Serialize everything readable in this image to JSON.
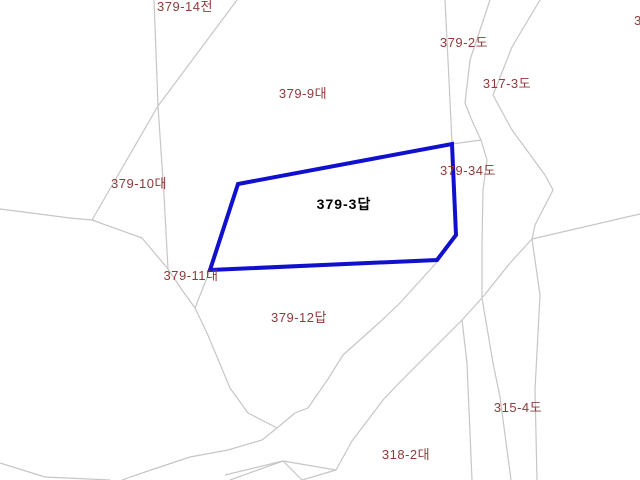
{
  "map": {
    "kind": "cadastral-parcel-map",
    "background": "#ffffff",
    "colors": {
      "boundary": "#c6c6c6",
      "highlight": "#1010cd",
      "label": "#8e3a3a",
      "highlight_label": "#000000"
    },
    "parcels": [
      {
        "label": "379-14전"
      },
      {
        "label": "379-2도"
      },
      {
        "label": "317-3도"
      },
      {
        "label": "379-9대"
      },
      {
        "label": "379-10대"
      },
      {
        "label": "379-34도"
      },
      {
        "label": "379-11대"
      },
      {
        "label": "379-12답"
      },
      {
        "label": "315-4도"
      },
      {
        "label": "318-2대"
      }
    ],
    "highlighted_parcel": {
      "label": "379-3답"
    },
    "edge_clipped_label": "3"
  }
}
